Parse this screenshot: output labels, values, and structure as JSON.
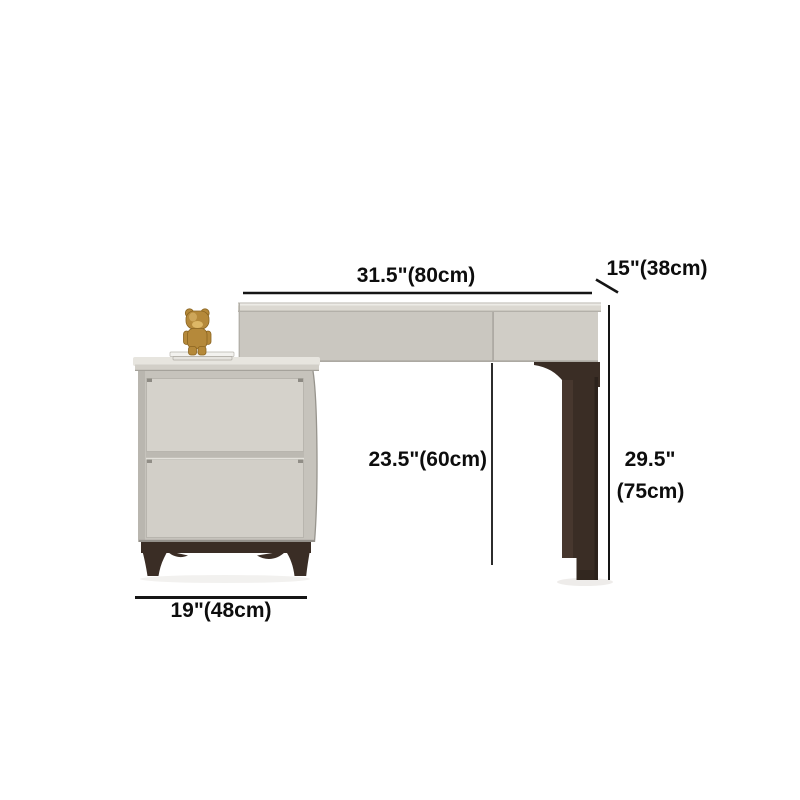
{
  "diagram": {
    "kind": "furniture-dimension-diagram",
    "objects": [
      "vanity-desk-with-drawers",
      "two-drawer-side-cabinet",
      "gold-bear-figurine",
      "book-stack"
    ],
    "labels": {
      "desk_width": "31.5\"(80cm)",
      "desk_depth": "15\"(38cm)",
      "under_desk_height": "23.5\"(60cm)",
      "overall_height_inches": "29.5\"",
      "overall_height_cm": "(75cm)",
      "cabinet_width": "19\"(48cm)"
    }
  },
  "colors": {
    "background": "#ffffff",
    "label-text": "#0d0d0d",
    "dimension-line": "#151515",
    "furniture-light": "#cac7c0",
    "furniture-light-top": "#dbd8d1",
    "furniture-highlight": "#ecebe6",
    "cabinet-top": "#e7e5df",
    "drawer-front": "#d5d2cb",
    "wood-dark": "#3a2d25",
    "wood-face": "#4a3930",
    "wood-edge": "#2c221c",
    "gold": "#b5893a",
    "gold-light": "#ddb766",
    "gold-dark": "#8a6420",
    "book-white": "#f3f2ef"
  }
}
